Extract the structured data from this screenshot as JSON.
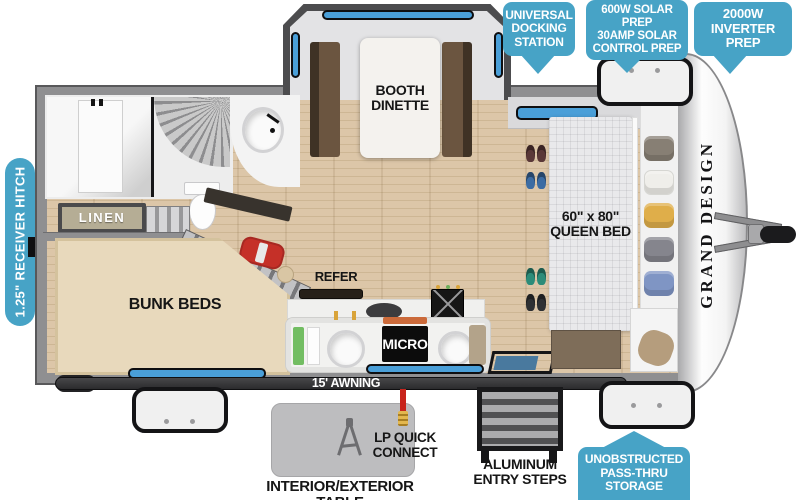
{
  "callouts": {
    "docking": {
      "lines": [
        "UNIVERSAL",
        "DOCKING",
        "STATION"
      ]
    },
    "solar": {
      "lines": [
        "600W SOLAR PREP",
        "30AMP SOLAR",
        "CONTROL PREP"
      ]
    },
    "inverter": {
      "lines": [
        "2000W",
        "INVERTER",
        "PREP"
      ]
    },
    "passthru": {
      "lines": [
        "UNOBSTRUCTED",
        "PASS-THRU",
        "STORAGE"
      ]
    },
    "hitch": "1.25\" RECEIVER HITCH"
  },
  "interior": {
    "dinette": {
      "lines": [
        "BOOTH",
        "DINETTE"
      ]
    },
    "linen": "LINEN",
    "bunk": "BUNK BEDS",
    "refer": "REFER",
    "micro": "MICRO",
    "queen": {
      "lines": [
        "60\" x 80\"",
        "QUEEN BED"
      ]
    }
  },
  "exterior": {
    "awning": "15' AWNING",
    "lp": {
      "lines": [
        "LP QUICK",
        "CONNECT"
      ]
    },
    "steps": {
      "lines": [
        "ALUMINUM",
        "ENTRY STEPS"
      ]
    },
    "table": "INTERIOR/EXTERIOR TABLE",
    "brand": "GRAND DESIGN"
  },
  "colors": {
    "teal": "#47a3c6",
    "wall": "#8f8f91",
    "floor": "#d8c2a4",
    "window": "#4a9fd8",
    "bunk": "#e8d9bc",
    "bench": "#5a4635",
    "bed": "#e9e9eb",
    "micro_bg": "#0c0c0c",
    "awning_bar": "#2b2b2d",
    "table_gray": "#bdbdbf",
    "hose_red": "#c8241c",
    "brass": "#d9a43a",
    "duffel_red": "#c53028",
    "label_text": "#161616"
  }
}
